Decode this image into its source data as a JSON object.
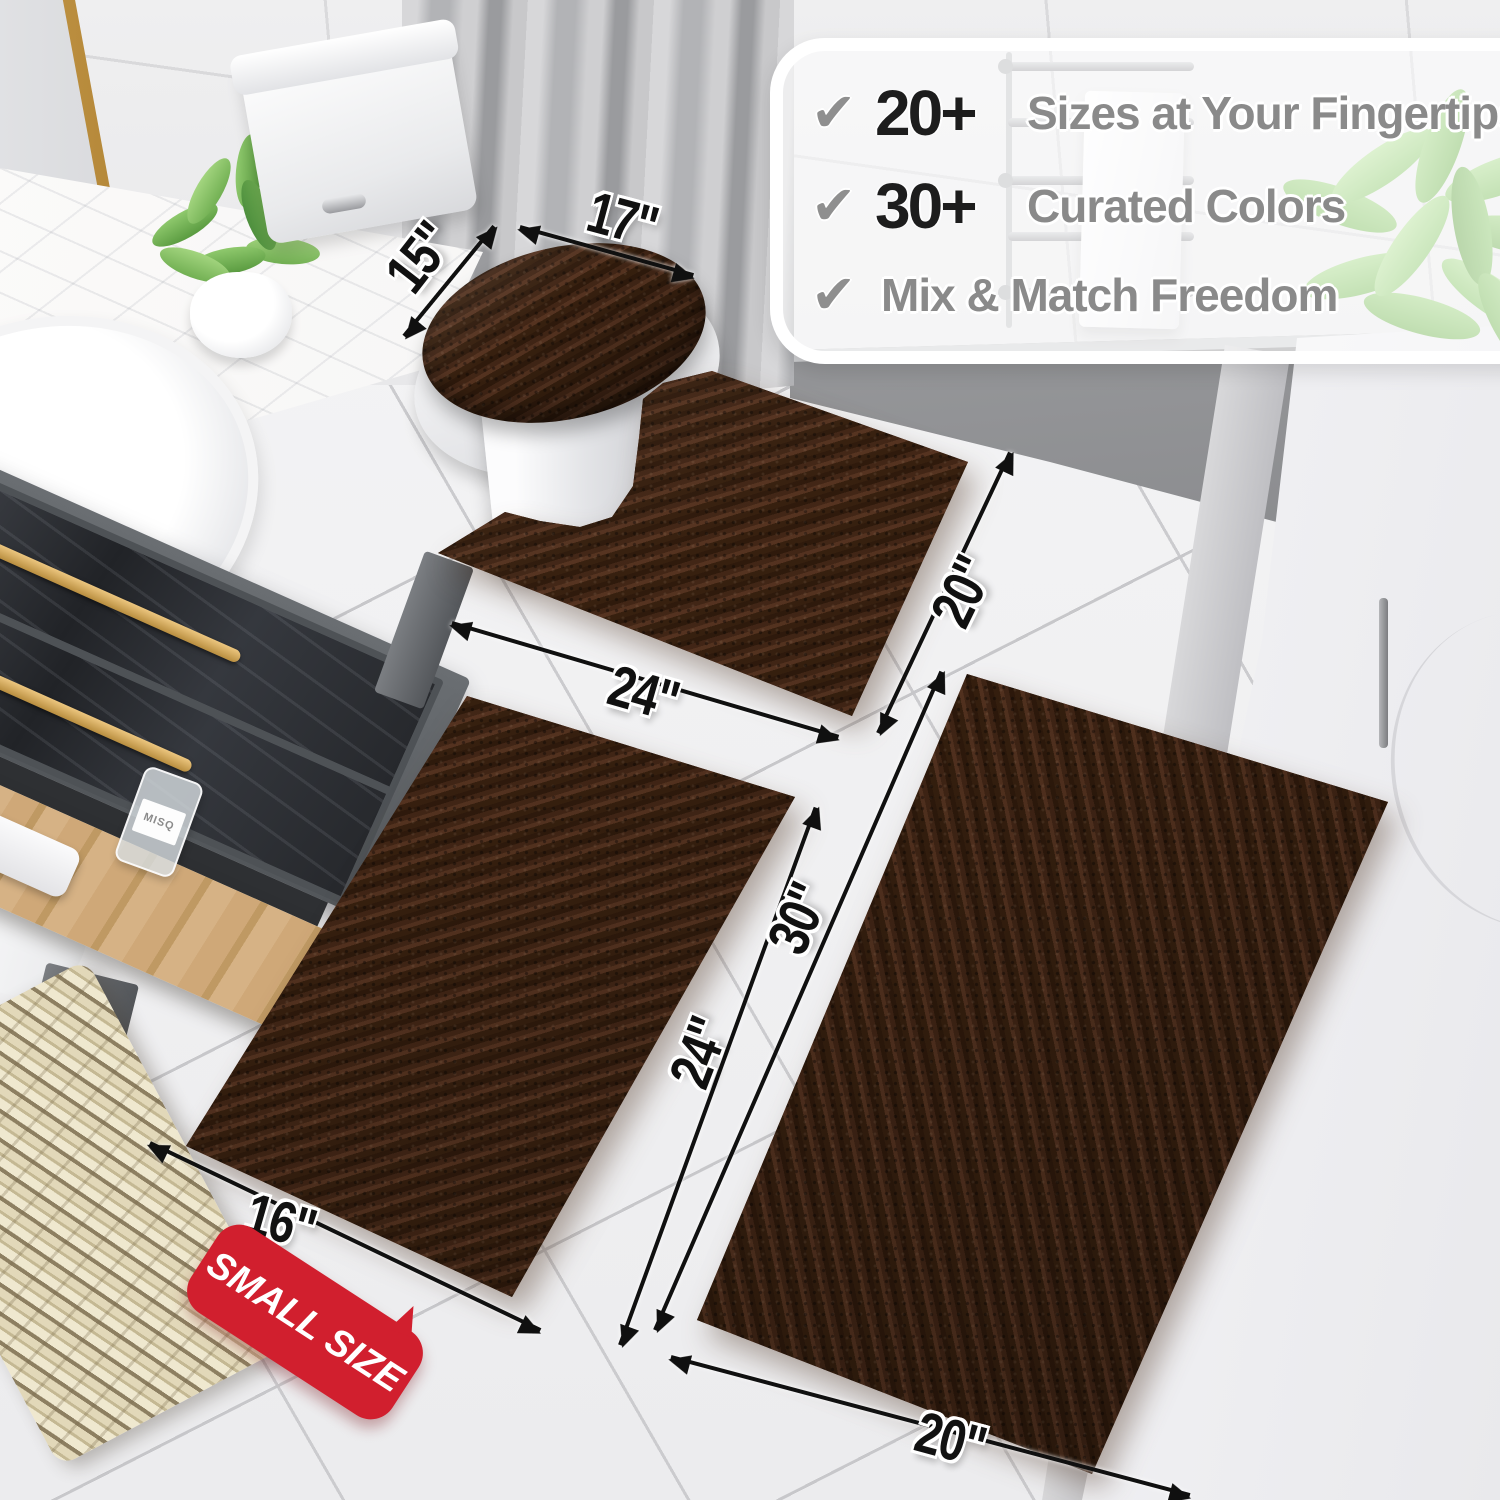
{
  "callout": {
    "check_icon": "✔",
    "items": [
      {
        "prefix": "20+",
        "label": "Sizes at Your Fingertips"
      },
      {
        "prefix": "30+",
        "label": "Curated Colors"
      },
      {
        "prefix": "",
        "label": "Mix & Match Freedom"
      }
    ]
  },
  "dimensions": {
    "lid_depth": "15\"",
    "lid_width": "17\"",
    "contour_width": "24\"",
    "contour_depth": "20\"",
    "small_width": "16\"",
    "small_depth": "24\"",
    "runner_length": "30\"",
    "runner_width": "20\""
  },
  "badge": {
    "label": "SMALL SIZE",
    "color": "#d11f2e"
  },
  "props": {
    "bottle_label": "MISQ"
  },
  "colors": {
    "rug_brown": "#46281a",
    "badge_red": "#d11f2e",
    "dimension_text": "#111111",
    "feature_number": "#1d1d1d",
    "feature_text": "#8a8a8a",
    "check_gray": "#8f8f8f"
  }
}
